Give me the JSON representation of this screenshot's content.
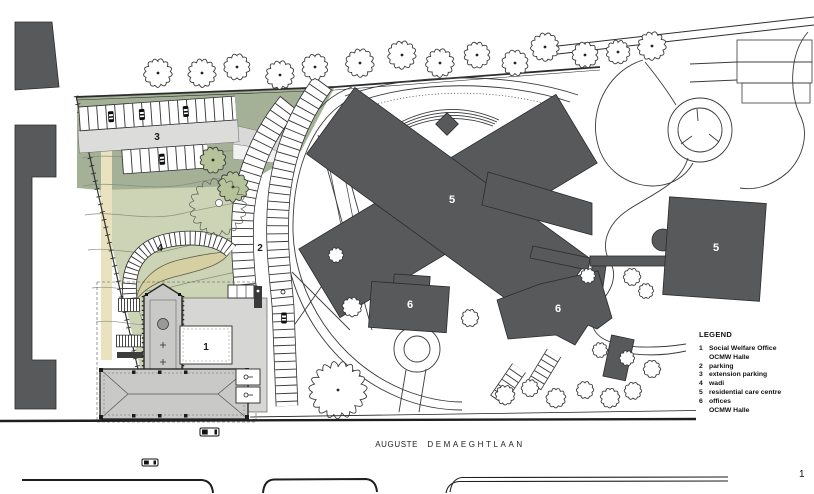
{
  "zones": {
    "social_welfare_office": "1",
    "parking": "2",
    "extension_parking": "3",
    "wadi": "4",
    "residential_care_centre": "5",
    "offices": "6"
  },
  "street": {
    "primary": "AUGUSTE",
    "secondary": "DEMAEGHTLAAN"
  },
  "legend": {
    "title": "LEGEND",
    "items": [
      {
        "num": "1",
        "label": "Social Welfare Office",
        "sub": "OCMW Halle"
      },
      {
        "num": "2",
        "label": "parking"
      },
      {
        "num": "3",
        "label": "extension parking"
      },
      {
        "num": "4",
        "label": "wadi"
      },
      {
        "num": "5",
        "label": "residential care centre"
      },
      {
        "num": "6",
        "label": "offices",
        "sub": "OCMW Halle"
      }
    ]
  },
  "corner_mark": "1",
  "colors": {
    "building_dark": "#58595b",
    "lawn_green": "#ccd4b5",
    "lawn_green_dark": "#a4b196",
    "path_beige": "#eae2bf",
    "aisle_gray": "#dcdcdb",
    "plan_gray": "#c9c9c7",
    "plaza_gray": "#d6d6d4",
    "tree_green": "#b5c29a",
    "hedge_tan": "#d5cfa2"
  }
}
